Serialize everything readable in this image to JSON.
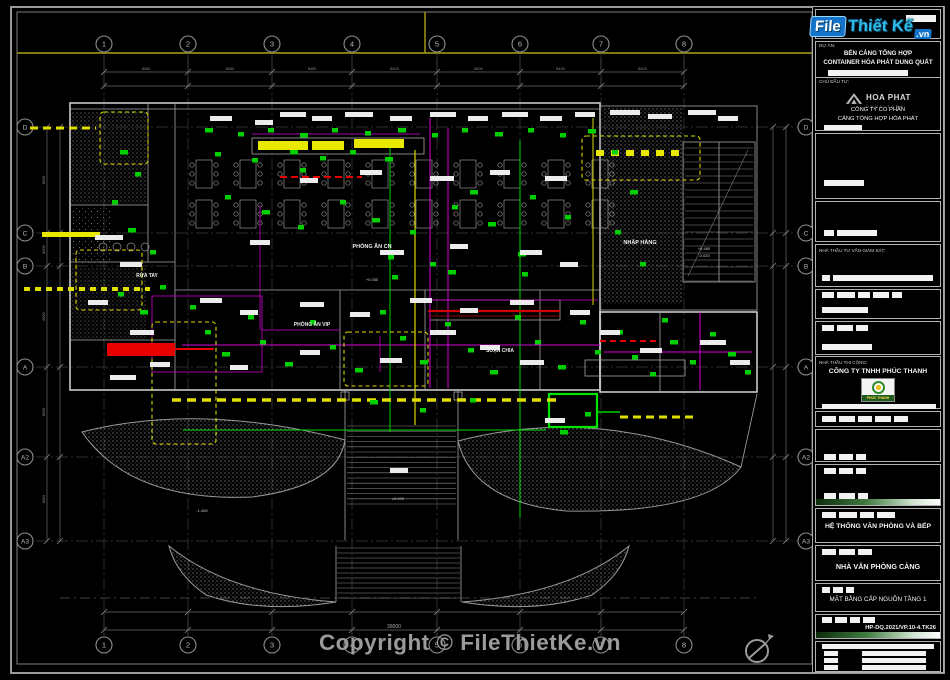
{
  "meta": {
    "copyright": "Copyright © FileThietKe.vn"
  },
  "logo": {
    "file": "File",
    "thietke": "Thiết Kế",
    "vn": ".vn"
  },
  "titleblock": {
    "du_an_label": "DỰ ÁN:",
    "du_an_line1": "BẾN CẢNG TỔNG HỢP",
    "du_an_line2": "CONTAINER HÒA PHÁT DUNG QUẤT",
    "chu_dau_tu_label": "CHỦ ĐẦU TƯ:",
    "hoaphat_name": "HOA PHAT",
    "hoaphat_sub": "GANG THÉP",
    "chu_dau_tu_line1": "CÔNG TY CỔ PHẦN",
    "chu_dau_tu_line2": "CẢNG TỔNG HỢP HÒA PHÁT",
    "giam_sat_label": "NHÀ THẦU TƯ VẤN GIÁM SÁT:",
    "thi_cong_label": "NHÀ THẦU THI CÔNG:",
    "thi_cong_name": "CÔNG TY TNHH PHÚC THANH",
    "phucthanh_logo_text": "PHÚC THANH",
    "system_title": "HỆ THỐNG VĂN PHÒNG VÀ BẾP",
    "building_title": "NHÀ VĂN PHÒNG CẢNG",
    "drawing_title": "MẶT BẰNG CẤP NGUỒN TẦNG 1",
    "drawing_number": "HP-DQ.2021/VP.10-4.TK26"
  },
  "plan": {
    "grid": {
      "cols": [
        "1",
        "2",
        "3",
        "4",
        "5",
        "6",
        "7",
        "8"
      ],
      "rows": [
        "D",
        "C",
        "B",
        "A",
        "A2",
        "A3"
      ]
    },
    "rooms": [
      "PHÒNG ĂN CN",
      "RỬA TAY",
      "PHÒNG ĂN VIP",
      "SOẠN CHIA",
      "NHẬP HÀNG"
    ],
    "levels": [
      "+0.050",
      "±0.000",
      "+0.480",
      "-0.020",
      "-1.450"
    ],
    "dims": {
      "total": "38000",
      "bay": "8400",
      "side": "6000"
    },
    "colors": {
      "wiring_magenta": "#d400d4",
      "device_green": "#00cf00",
      "highlight_yellow": "#e0e000",
      "alert_red": "#e60000"
    }
  }
}
